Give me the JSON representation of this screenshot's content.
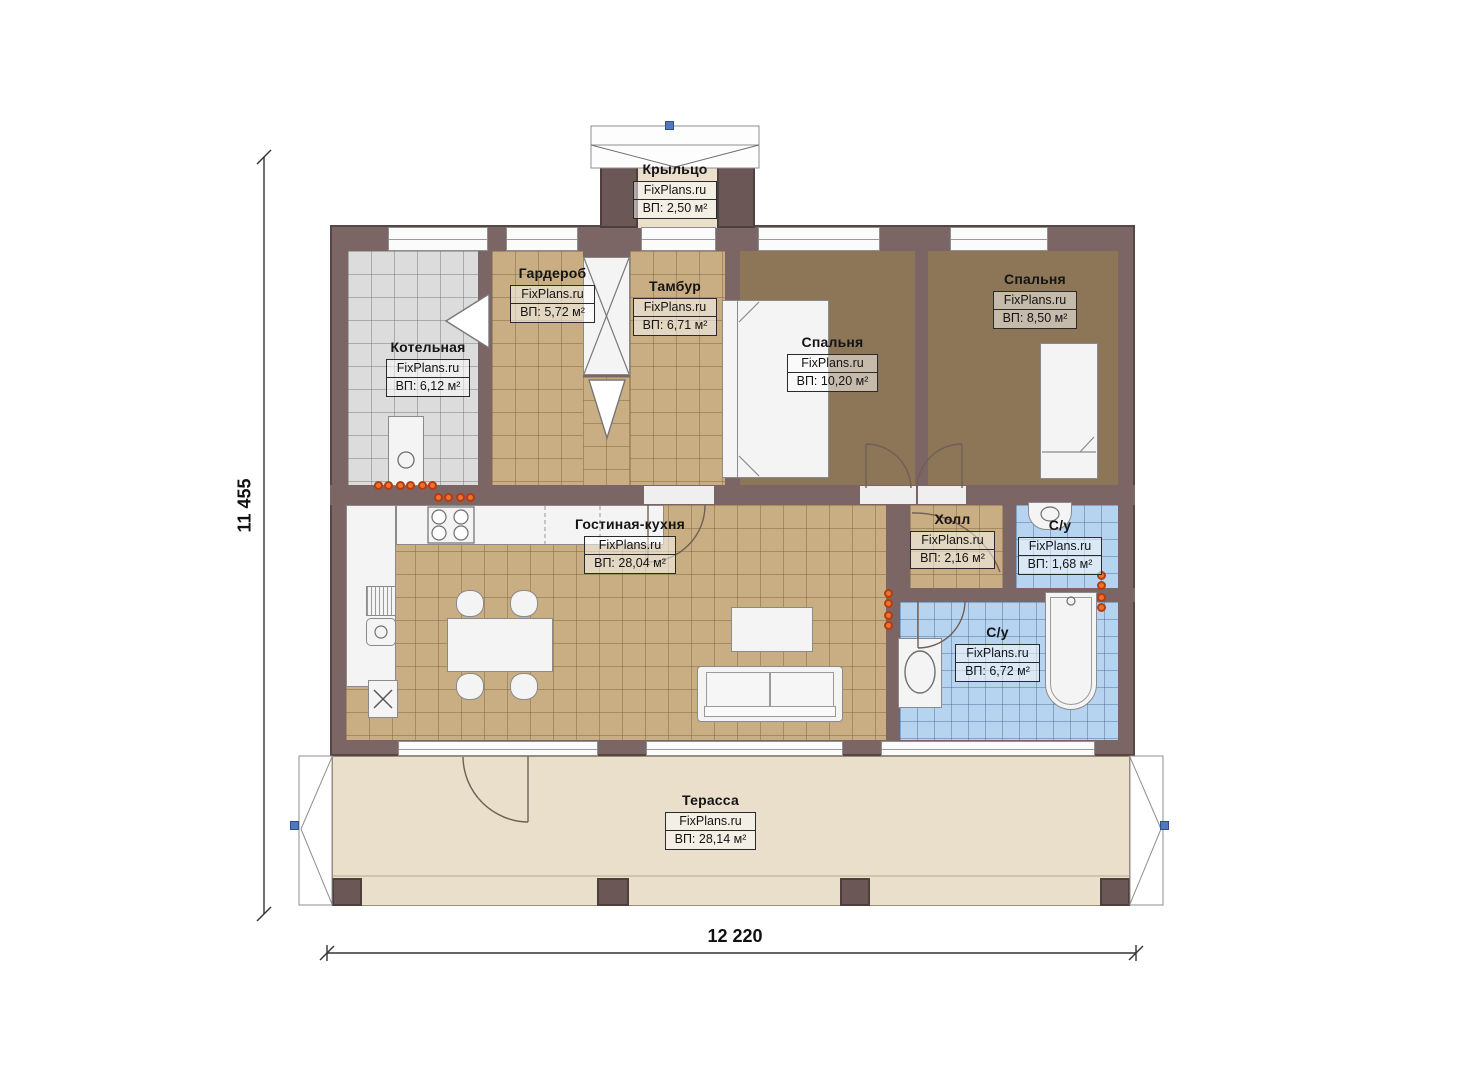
{
  "site": {
    "brand": "FixPlans.ru"
  },
  "dimensions": {
    "height_mm": "11 455",
    "width_mm": "12 220"
  },
  "rooms": [
    {
      "key": "porch",
      "name": "Крыльцо",
      "brand": "FixPlans.ru",
      "area": "ВП: 2,50 м²"
    },
    {
      "key": "boiler-room",
      "name": "Котельная",
      "brand": "FixPlans.ru",
      "area": "ВП: 6,12 м²"
    },
    {
      "key": "wardrobe",
      "name": "Гардероб",
      "brand": "FixPlans.ru",
      "area": "ВП: 5,72 м²"
    },
    {
      "key": "vestibule",
      "name": "Тамбур",
      "brand": "FixPlans.ru",
      "area": "ВП: 6,71 м²"
    },
    {
      "key": "bedroom-main",
      "name": "Спальня",
      "brand": "FixPlans.ru",
      "area": "ВП: 10,20 м²"
    },
    {
      "key": "bedroom-second",
      "name": "Спальня",
      "brand": "FixPlans.ru",
      "area": "ВП: 8,50 м²"
    },
    {
      "key": "living-kitchen",
      "name": "Гостиная-кухня",
      "brand": "FixPlans.ru",
      "area": "ВП: 28,04 м²"
    },
    {
      "key": "hall",
      "name": "Холл",
      "brand": "FixPlans.ru",
      "area": "ВП: 2,16 м²"
    },
    {
      "key": "bathroom-small",
      "name": "С/у",
      "brand": "FixPlans.ru",
      "area": "ВП: 1,68 м²"
    },
    {
      "key": "bathroom-large",
      "name": "С/у",
      "brand": "FixPlans.ru",
      "area": "ВП: 6,72 м²"
    },
    {
      "key": "terrace",
      "name": "Терасса",
      "brand": "FixPlans.ru",
      "area": "ВП: 28,14 м²"
    }
  ],
  "colors": {
    "wall": "#7c6565",
    "wall_dark": "#564646",
    "floor_tan": "#c9ae84",
    "floor_grey": "#dcdcdc",
    "floor_blue": "#b6d3ef",
    "floor_bedroom": "#8d7557",
    "floor_terrace": "#e9dfca",
    "outlet_orange": "#f07030",
    "grip_blue": "#5377bd"
  }
}
